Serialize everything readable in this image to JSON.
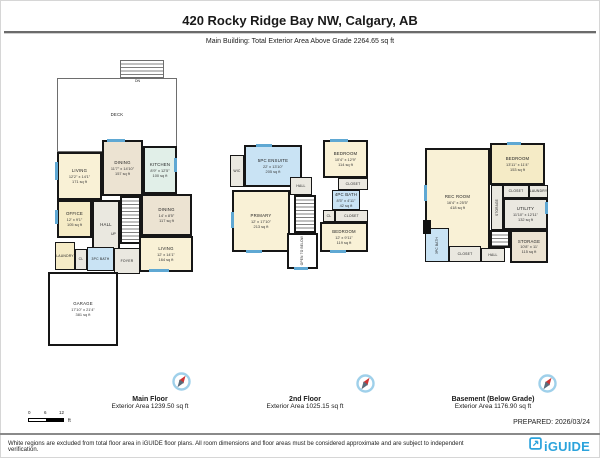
{
  "header": {
    "title": "420 Rocky Ridge Bay NW, Calgary, AB",
    "subtitle": "Main Building: Total Exterior Area Above Grade 2264.65 sq ft"
  },
  "floors": [
    {
      "label": "Main Floor",
      "area_label": "Exterior Area 1239.50 sq ft",
      "rooms": [
        {
          "name": "DECK"
        },
        {
          "name": "LIVING",
          "dims": "12'2\" x 14'1\"",
          "area": "171 sq ft"
        },
        {
          "name": "DINING",
          "dims": "11'7\" x 14'10\"",
          "area": "157 sq ft"
        },
        {
          "name": "KITCHEN",
          "dims": "8'9\" x 12'5\"",
          "area": "100 sq ft"
        },
        {
          "name": "OFFICE",
          "dims": "12' x 9'1\"",
          "area": "105 sq ft"
        },
        {
          "name": "DINING",
          "dims": "14' x 8'5\"",
          "area": "117 sq ft"
        },
        {
          "name": "LIVING",
          "dims": "12' x 14'1\"",
          "area": "164 sq ft"
        },
        {
          "name": "LAUNDRY"
        },
        {
          "name": "CL"
        },
        {
          "name": "3PC BATH"
        },
        {
          "name": "FOYER"
        },
        {
          "name": "GARAGE",
          "dims": "17'10\" x 21'4\"",
          "area": "381 sq ft"
        },
        {
          "name": "HALL"
        },
        {
          "name": "UP"
        },
        {
          "name": "DN"
        }
      ]
    },
    {
      "label": "2nd Floor",
      "area_label": "Exterior Area 1025.15 sq ft",
      "rooms": [
        {
          "name": "5PC ENSUITE",
          "dims": "22' x 13'10\"",
          "area": "205 sq ft"
        },
        {
          "name": "WIC"
        },
        {
          "name": "BEDROOM",
          "dims": "10'4\" x 12'9\"",
          "area": "114 sq ft"
        },
        {
          "name": "CLOSET"
        },
        {
          "name": "4PC BATH",
          "dims": "8'5\" x 4'11\"",
          "area": "42 sq ft"
        },
        {
          "name": "CL"
        },
        {
          "name": "CLOSET"
        },
        {
          "name": "PRIMARY",
          "dims": "12' x 17'10\"",
          "area": "213 sq ft"
        },
        {
          "name": "HALL"
        },
        {
          "name": "BEDROOM",
          "dims": "12' x 9'11\"",
          "area": "119 sq ft"
        },
        {
          "name": "OPEN TO BELOW"
        },
        {
          "name": "DN"
        }
      ]
    },
    {
      "label": "Basement (Below Grade)",
      "area_label": "Exterior Area 1176.90 sq ft",
      "rooms": [
        {
          "name": "REC ROOM",
          "dims": "16'4\" x 25'5\"",
          "area": "418 sq ft"
        },
        {
          "name": "BEDROOM",
          "dims": "13'11\" x 11'4\"",
          "area": "153 sq ft"
        },
        {
          "name": "CLOSET"
        },
        {
          "name": "STORAGE"
        },
        {
          "name": "LAUNDRY"
        },
        {
          "name": "UTILITY",
          "dims": "11'10\" x 12'11\"",
          "area": "132 sq ft"
        },
        {
          "name": "STORAGE",
          "dims": "10'8\" x 11'",
          "area": "115 sq ft"
        },
        {
          "name": "3PC BATH"
        },
        {
          "name": "CLOSET"
        },
        {
          "name": "HALL"
        }
      ]
    }
  ],
  "scale_bar": {
    "tick0": "0",
    "tick1": "6",
    "tick2": "12",
    "unit": "ft"
  },
  "prepared": "PREPARED: 2026/03/24",
  "footer": {
    "disclaimer": "White regions are excluded from total floor area in iGUIDE floor plans. All room dimensions and floor areas must be considered approximate and are subject to independent verification.",
    "brand": "iGUIDE"
  },
  "colors": {
    "accent_blue": "#2ba3dc",
    "window_blue": "#5fa8d3",
    "room_cream": "#f9f1d6",
    "room_beige": "#ece3d2",
    "room_bath": "#c9e3f4",
    "room_kitchen": "#e1efe8",
    "wall": "#161616"
  }
}
